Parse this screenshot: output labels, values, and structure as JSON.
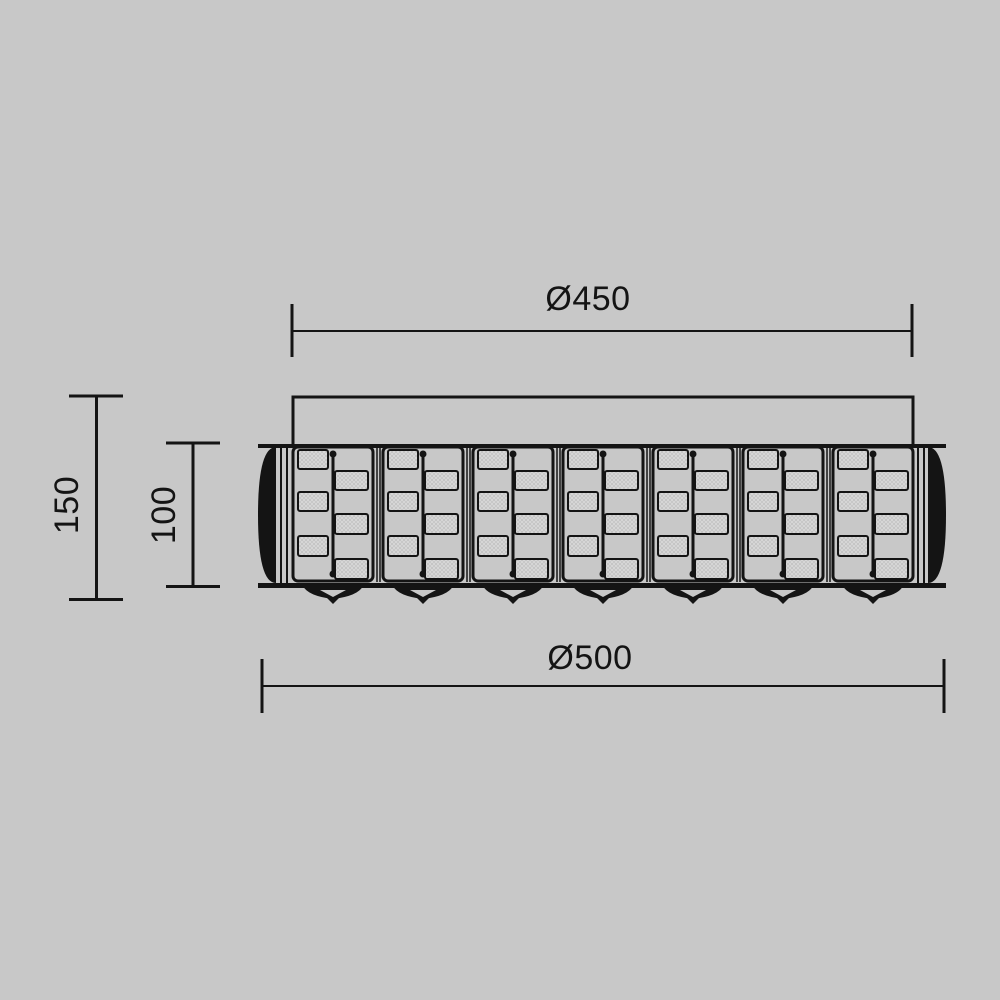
{
  "page": {
    "background_color": "#c8c8c8",
    "line_color": "#141414",
    "crystal_fill": "#d6d6d6",
    "crystal_dot": "#9b9b9b"
  },
  "drawing": {
    "kind": "technical-dimension-drawing",
    "subject": "crystal ceiling lamp, front elevation",
    "panel_count": 7,
    "finial_count": 7,
    "dimensions": {
      "top_diameter": "Ø450",
      "bottom_diameter": "Ø500",
      "overall_height": "150",
      "body_height": "100"
    }
  }
}
